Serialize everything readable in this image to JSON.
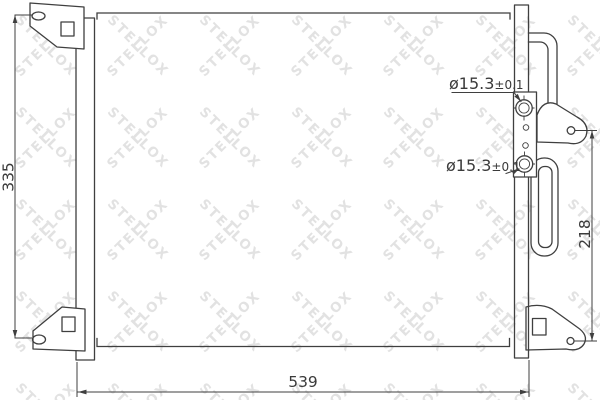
{
  "watermark": {
    "text": "STELLOX",
    "color": "#e2e2e2"
  },
  "style": {
    "line_color": "#3f3f3f",
    "background": "#ffffff"
  },
  "dimensions": {
    "left_height": "335",
    "bottom_width": "539",
    "right_height": "218"
  },
  "fittings": {
    "top": {
      "diameter": "ø15.3",
      "tolerance": "±0.1"
    },
    "bottom": {
      "diameter": "ø15.3",
      "tolerance": "±0.1"
    }
  }
}
